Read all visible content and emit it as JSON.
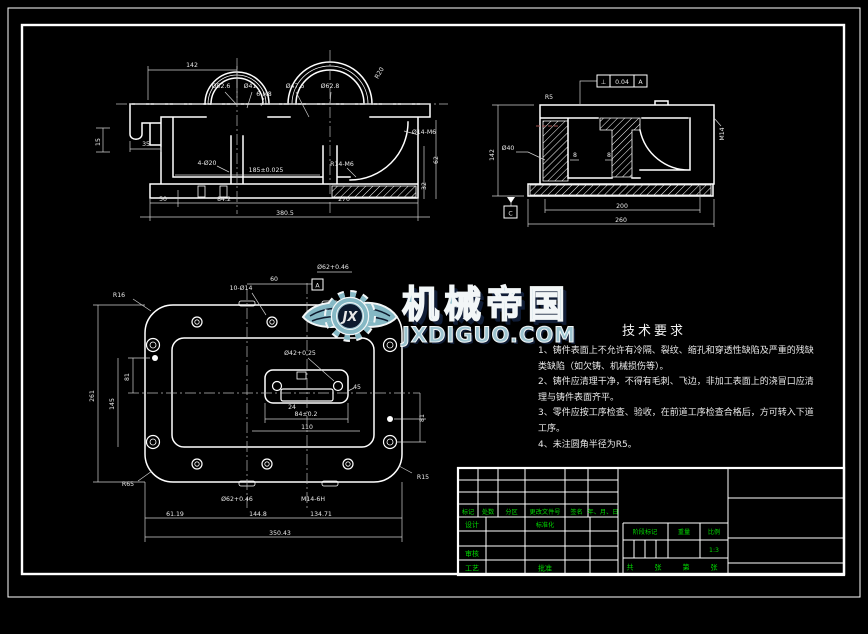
{
  "colors": {
    "background": "#000000",
    "line": "#ffffff",
    "titleblock_text": "#00d800",
    "watermark_fill": "#8fbdca",
    "watermark_outline": "#f2f6f7",
    "watermark_shadow": "#101d36",
    "hidden_line_red": "#a3524f"
  },
  "watermark": {
    "brand": "机械帝国",
    "domain": "JXDIGUO.COM",
    "monogram": "JX"
  },
  "tech": {
    "title": "技术要求",
    "lines": [
      "1、铸件表面上不允许有冷隔、裂纹、缩孔和穿透性缺陷及严重的残缺",
      "类缺陷（如欠铸、机械损伤等）。",
      "2、铸件应清理干净，不得有毛刺、飞边，非加工表面上的浇冒口应清",
      "理与铸件表面齐平。",
      "3、零件应按工序检查、验收，在前道工序检查合格后，方可转入下道",
      "工序。",
      "4、未注圆角半径为R5。"
    ]
  },
  "views": {
    "front": {
      "labels": [
        "142",
        "Ø52.6",
        "Ø41",
        "6-M8",
        "Ø47.6",
        "Ø62.8",
        "R20",
        "15",
        "35",
        "4-Ø20",
        "185±0.025",
        "Ø14-M6",
        "R14-M6",
        "62",
        "32",
        "50",
        "84.2",
        "270",
        "380.5"
      ]
    },
    "side": {
      "labels": [
        "R5",
        "142",
        "Ø40",
        "8",
        "8",
        "M14",
        "200",
        "260"
      ],
      "tolerance": {
        "sym": "⊥",
        "val": "0.04",
        "ref": "A"
      },
      "datum": "C"
    },
    "plan": {
      "labels": [
        "R16",
        "10-Ø14",
        "60",
        "Ø62+0.46",
        "81",
        "145",
        "261",
        "Ø42+0.25",
        "45",
        "24",
        "84±0.2",
        "110",
        "81",
        "R15",
        "R65",
        "Ø62+0.46",
        "M14-6H",
        "61.19",
        "144.8",
        "134.71",
        "350.43"
      ],
      "datum": "A"
    }
  },
  "title_block": {
    "rev_headers": [
      "标记",
      "处数",
      "分区",
      "更改文件号",
      "签名",
      "年、月、日"
    ],
    "design": "设计",
    "standardize": "标准化",
    "audit": "审核",
    "process": "工艺",
    "approve": "批准",
    "stage": "阶段标记",
    "weight": "重量",
    "scale_label": "比例",
    "scale": "1:3",
    "pages": [
      "共",
      "张",
      "第",
      "张"
    ]
  }
}
